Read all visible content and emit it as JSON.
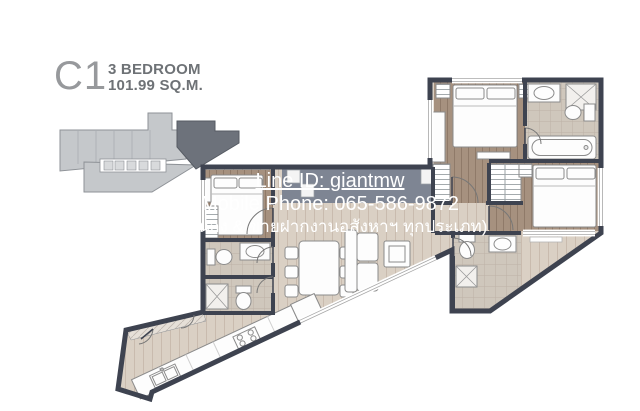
{
  "page": {
    "background": "#ffffff"
  },
  "title": {
    "unit_code": "C1",
    "bedroom_label": "3 BEDROOM",
    "area_label": "101.99 SQ.M."
  },
  "watermark": {
    "line1": "สนใจติดต่อ เติ้ม รัชดา",
    "line2": "Line ID: giantmw",
    "line3": "Mobile Phone: 065-586-9872",
    "line4": "(จำนอง & ขายฝากงานอสังหาฯ ทุกประเภท)",
    "color": "#ffffff"
  },
  "key_plan": {
    "highlighted_unit": "C1",
    "building_color": "#c5c8cb",
    "highlight_color": "#6d727b"
  },
  "floor_plan": {
    "wall_color": "#3e4350",
    "wood_floor_color": "#a6917f",
    "light_floor_color": "#dad0c4",
    "tile_floor_color": "#cfc7bc",
    "ledge_color": "#7e8593",
    "rooms": [
      "master-bedroom",
      "master-bathroom",
      "bedroom-2",
      "bedroom-3",
      "bathroom-1",
      "bathroom-2",
      "bathroom-3",
      "living-dining",
      "kitchen",
      "walk-in-closet",
      "balcony-ledge"
    ]
  }
}
